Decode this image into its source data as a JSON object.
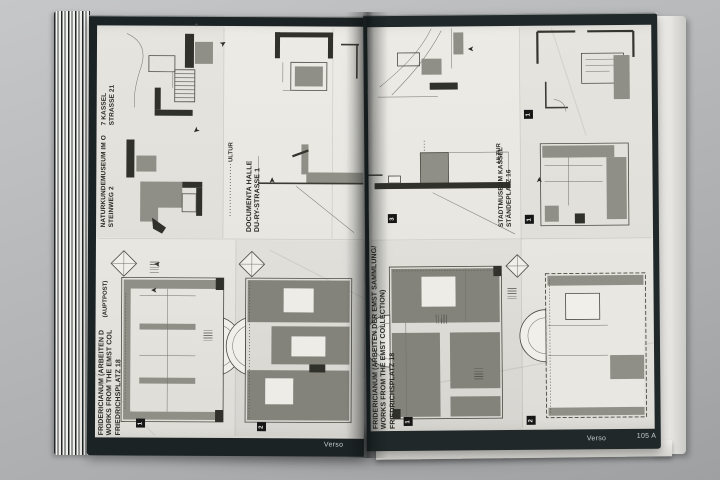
{
  "icons": {
    "arrow": "➤",
    "plus": "+"
  },
  "colors": {
    "backdrop": "#b4b5b7",
    "page_border": "#1f2728",
    "paper": "#e9e8e2",
    "plan_gray": "#8f8f87",
    "plan_dark": "#31312c",
    "footer_text": "#c9cccb"
  },
  "left_page": {
    "captions": {
      "venue1": {
        "line1": "7 KASSEL",
        "line2": "STRASSE 21"
      },
      "venue2": {
        "line1": "NATURKUNDEMUSEUM IM O",
        "line2": "STEINWEG 2"
      },
      "kultur_fragment": "ULTUR",
      "venue3": {
        "line1": "DOCUMENTA HALLE",
        "line2": "DU-RY-STRASSE 1"
      },
      "venue4": {
        "line1": "FRIDERICIANUM (ARBEITEN D",
        "line2": "WORKS FROM THE EMST COL",
        "line3": "FRIEDRICHSPLATZ 18",
        "fragment": "(AUPTPOST)"
      }
    },
    "badges": [
      "1",
      "2"
    ],
    "footer": {
      "label": "Verso"
    }
  },
  "right_page": {
    "captions": {
      "kultur_fragment": "ULTUR",
      "venue1": {
        "line1": "STADTMUSEUM KASSEL",
        "line2": "STÄNDEPLATZ 16"
      },
      "venue2": {
        "line1": "FRIDERICIANUM (ARBEITEN DER EMST SAMMLUNG/",
        "line2": "WORKS FROM THE EMST COLLECTION)",
        "line3": "FRIEDRICHSPLATZ 18"
      }
    },
    "badges_top": [
      "1",
      "1",
      "3"
    ],
    "badges_bottom": [
      "1",
      "2"
    ],
    "footer": {
      "label": "Verso",
      "page_number": "105 A"
    }
  }
}
